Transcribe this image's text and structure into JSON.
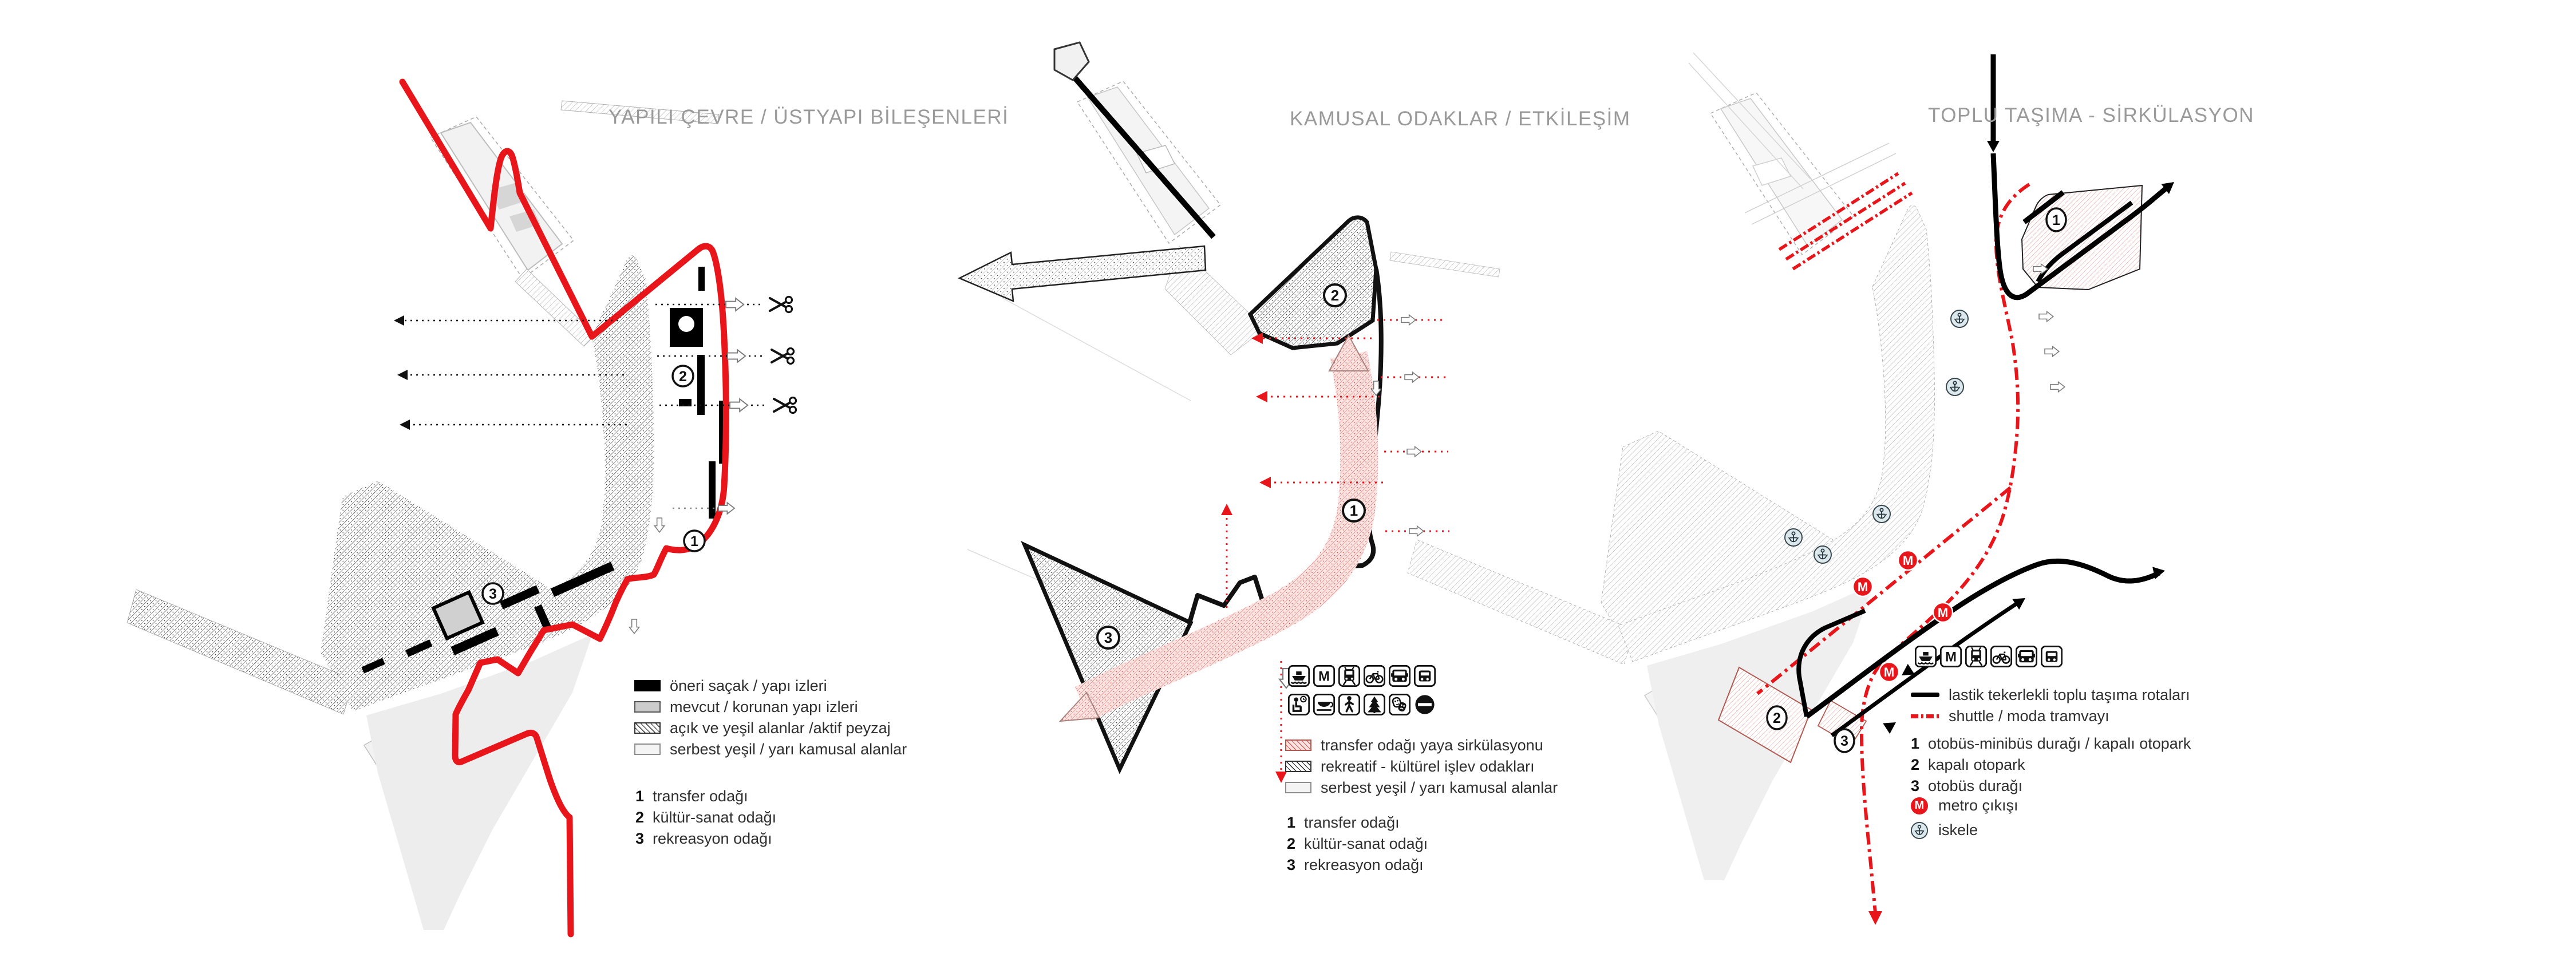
{
  "colors": {
    "accent_red": "#e8151b",
    "hatch_pink_bg": "#fbe3e1",
    "hatch_pink_line": "#d4635c",
    "title_gray": "#9a9a9a",
    "metro_red": "#e8151b",
    "pier_badge_bg": "#dce8ec",
    "map_base_gray": "#f2f2f2"
  },
  "panels": [
    {
      "id": "built-environment",
      "title": "YAPILI ÇEVRE / ÜSTYAPI BİLEŞENLERİ",
      "map_labels": [
        "1",
        "2",
        "3"
      ],
      "legend": {
        "swatches": [
          {
            "style": "solid-black",
            "label": "öneri saçak / yapı izleri"
          },
          {
            "style": "solid-gray",
            "label": "mevcut / korunan yapı izleri"
          },
          {
            "style": "hatch-black",
            "label": "açık ve yeşil alanlar /aktif peyzaj"
          },
          {
            "style": "solid-lightgray",
            "label": "serbest yeşil / yarı kamusal alanlar"
          }
        ],
        "numbered": [
          {
            "num": "1",
            "label": "transfer odağı"
          },
          {
            "num": "2",
            "label": "kültür-sanat odağı"
          },
          {
            "num": "3",
            "label": "rekreasyon odağı"
          }
        ]
      }
    },
    {
      "id": "public-focuses",
      "title": "KAMUSAL ODAKLAR / ETKİLEŞİM",
      "map_labels": [
        "1",
        "2",
        "3"
      ],
      "icons_row1": [
        "ferry",
        "metro",
        "tram",
        "bicycle",
        "bus",
        "minibus"
      ],
      "icons_row2": [
        "waiting",
        "cafe",
        "pedestrian",
        "park",
        "theater",
        "no-entry"
      ],
      "legend": {
        "swatches": [
          {
            "style": "hatch-pink",
            "label": "transfer odağı yaya sirkülasyonu"
          },
          {
            "style": "hatch-black",
            "label": "rekreatif - kültürel işlev odakları"
          },
          {
            "style": "solid-lightgray",
            "label": "serbest yeşil / yarı kamusal alanlar"
          }
        ],
        "numbered": [
          {
            "num": "1",
            "label": "transfer odağı"
          },
          {
            "num": "2",
            "label": "kültür-sanat odağı"
          },
          {
            "num": "3",
            "label": "rekreasyon odağı"
          }
        ]
      }
    },
    {
      "id": "public-transport",
      "title": "TOPLU TAŞIMA - SİRKÜLASYON",
      "map_labels": [
        "1",
        "2",
        "3"
      ],
      "metro_symbol": "M",
      "icons_row": [
        "ferry",
        "metro",
        "tram",
        "bicycle",
        "bus",
        "minibus"
      ],
      "legend": {
        "lines": [
          {
            "style": "solid-black",
            "label": "lastik tekerlekli toplu taşıma rotaları"
          },
          {
            "style": "dash-red",
            "label": "shuttle / moda tramvayı"
          }
        ],
        "numbered": [
          {
            "num": "1",
            "label": "otobüs-minibüs durağı / kapalı otopark"
          },
          {
            "num": "2",
            "label": "kapalı otopark"
          },
          {
            "num": "3",
            "label": "otobüs durağı"
          }
        ],
        "symbols": [
          {
            "icon": "metro-exit",
            "label": "metro çıkışı"
          },
          {
            "icon": "pier-anchor",
            "label": "iskele"
          }
        ]
      }
    }
  ]
}
